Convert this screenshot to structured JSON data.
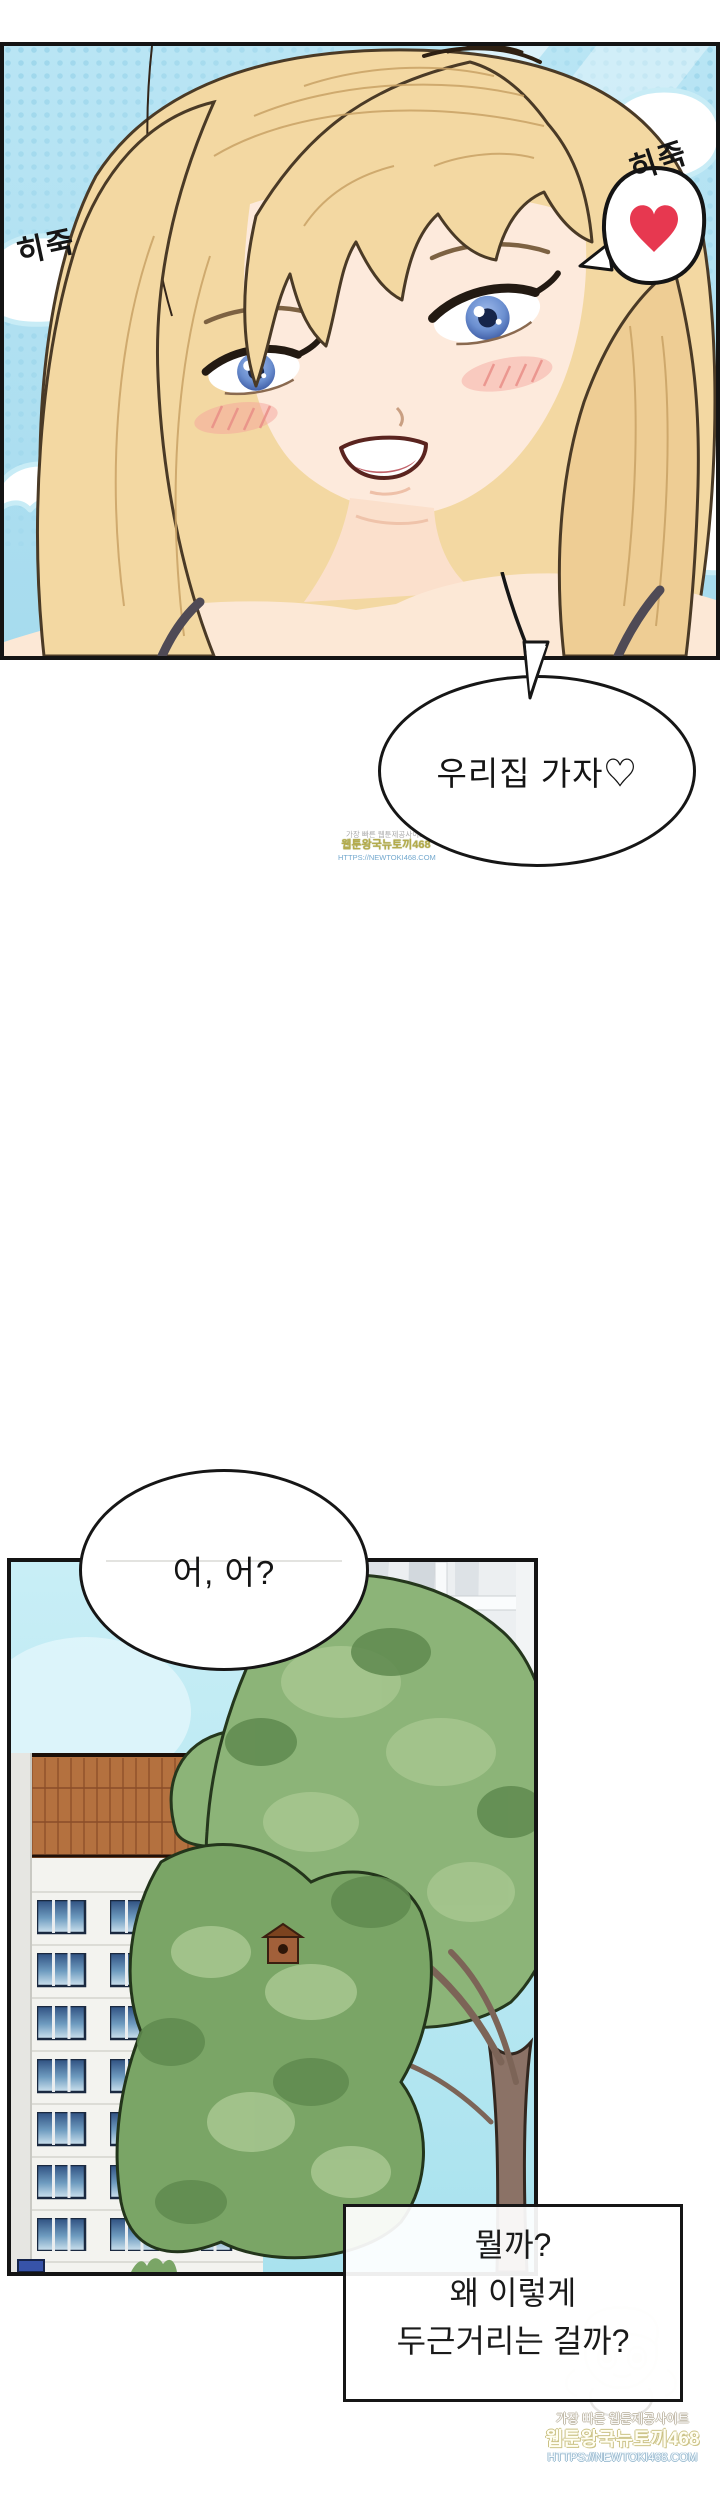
{
  "panel1": {
    "sfx_left": "히죽",
    "sfx_right": "히죽"
  },
  "speech1": {
    "text": "우리집 가자♡"
  },
  "speech2": {
    "text": "어, 어?"
  },
  "thought_box": {
    "line1": "뭘까?",
    "line2": "왜 이렇게",
    "line3": "두근거리는 걸까?"
  },
  "watermark_mid": {
    "tagline": "가장 빠른 웹툰제공사이트",
    "site": "웹툰왕국뉴토끼468",
    "url": "HTTPS://NEWTOKI468.COM"
  },
  "watermark_bottom": {
    "tagline": "가장 빠른 웹툰제공사이트",
    "site": "웹툰왕국뉴토끼468",
    "url": "HTTPS://NEWTOKI468.COM"
  },
  "colors": {
    "heart_red": "#e73850",
    "sky_blue": "#b7e4f3",
    "panel2_sky": "#c8eef6",
    "hair_blonde": "#f3d8a2",
    "skin": "#fdeadc",
    "tree_green": "#8cb478",
    "roof_brick": "#b4713f",
    "window_blue": "#2e4f80",
    "ink": "#141414"
  }
}
